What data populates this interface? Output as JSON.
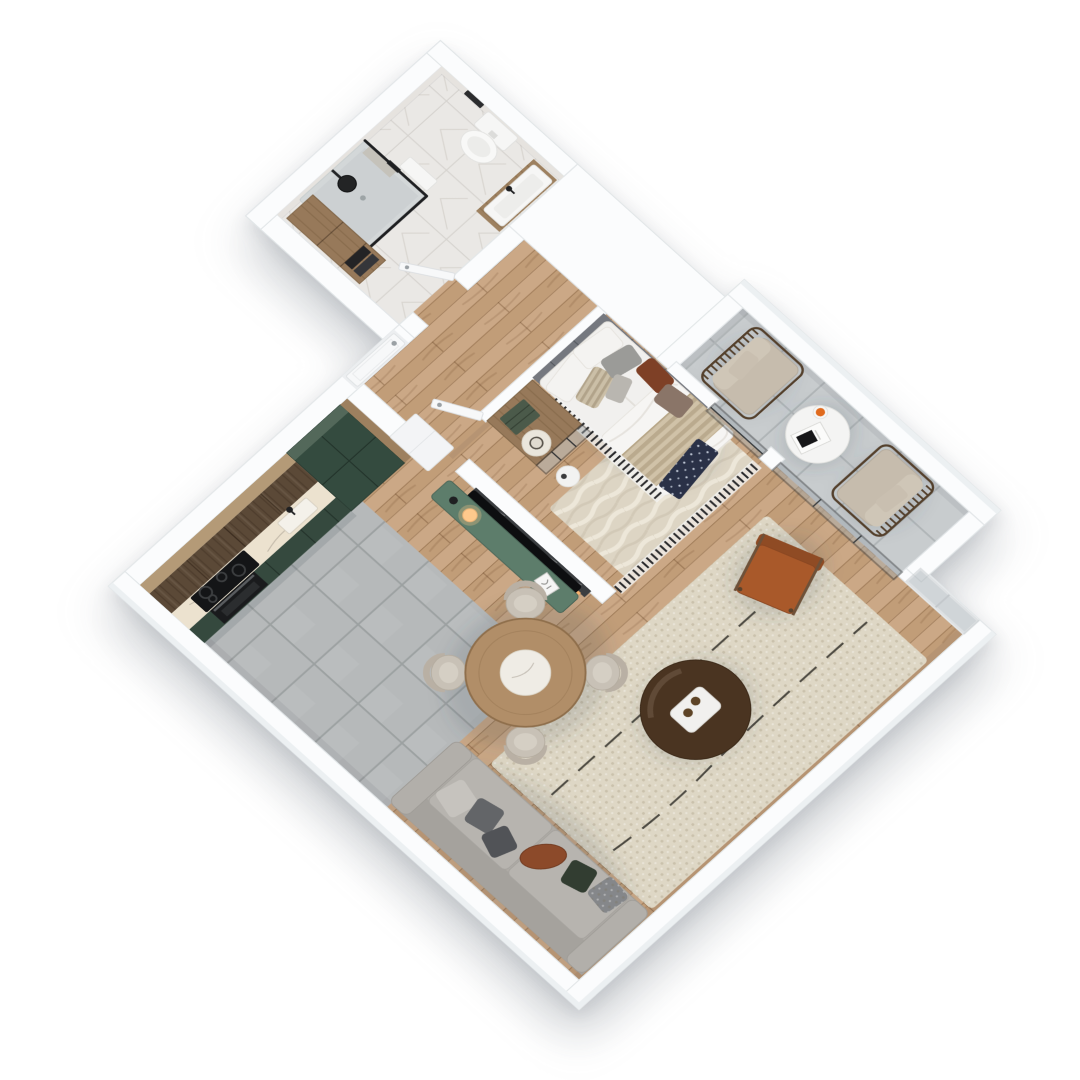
{
  "meta": {
    "description": "Photorealistic 3D axonometric floor plan rendering of a one-bedroom apartment, viewed top-down and rotated 45 degrees on a white background",
    "view": "axonometric top-down, rotated",
    "background": "#ffffff"
  },
  "palette": {
    "background": "#ffffff",
    "wall": "#fbfcfd",
    "floor_wood": "#c8a37e",
    "floor_tile_kitchen": "#b6b9ba",
    "floor_tile_balcony": "#c8ccce",
    "floor_marble": "#eae8e5",
    "cabinet_green_dark": "#344b3f",
    "cabinet_green_top": "#53685a",
    "cabinet_base_green": "#35493e",
    "wood_dark": "#5b4937",
    "wood_light": "#9d805f",
    "wood_cap": "#b49a77",
    "counter_marble": "#ece2cf",
    "appliance_black": "#141517",
    "oven_black": "#1a1b1d",
    "sink_white": "#f4f1ea",
    "console_green": "#5d7d6b",
    "tv_black": "#0d0e10",
    "tv_wall_marble": "#3b3e41",
    "led_warm": "#ffb66b",
    "sofa_base": "#aeaba6",
    "sofa_seat": "#b7b4af",
    "sofa_back": "#a5a29d",
    "pillow_light": "#c6c3be",
    "pillow_mid": "#636568",
    "pillow_dark": "#515357",
    "pillow_green": "#323d31",
    "pillow_leather": "#8c4a2a",
    "pillow_knit": "#85878a",
    "rug_living": "#ded7c5",
    "rug_bedroom": "#ddd5c4",
    "pouf_brown": "#4a3421",
    "tray_white": "#f1f0ee",
    "glass_drink": "#5e4426",
    "chair_leather": "#a9592a",
    "chair_leather_dark": "#8f4b24",
    "chair_wood": "#6e5139",
    "dining_wood": "#b18e68",
    "dining_marble": "#efece5",
    "dining_chair": "#c8c1b6",
    "bed_white": "#f1f0ee",
    "duvet": "#f6f5f3",
    "headboard_grey": "#75787f",
    "throw_beige": "#d0c2a8",
    "pillow_rust": "#7e4026",
    "pillow_taupe": "#8a7568",
    "blanket_navy": "#2a3147",
    "wardrobe_wood": "#97795a",
    "hat_white": "#eae6dc",
    "clothes_green": "#4b5a4a",
    "baluster_dark": "#2c2c2e",
    "glass_tint": "#a7b0b4",
    "frame_silver": "#c3c8cb",
    "door_white": "#f7f8f9",
    "handle_chrome": "#9aa0a4",
    "fixture_white": "#f6f6f5",
    "fixture_black": "#232425",
    "armchair_cushion": "#c6bcad",
    "armchair_frame": "#54402c",
    "side_table_white": "#f4f4f3",
    "cup_orange": "#e06a1d",
    "lamp_glow": "#ffc98c",
    "towel_dark": "#232325"
  },
  "scene": {
    "rooms": [
      {
        "id": "bathroom",
        "label": "Bathroom",
        "items": [
          "marble floor and walls",
          "black framed glass shower",
          "black rain shower head",
          "wall-hung toilet",
          "white basin on wood vanity",
          "tall wood cabinet",
          "dark towels",
          "towel bar",
          "open white door"
        ]
      },
      {
        "id": "hallway",
        "label": "Hallway",
        "items": [
          "white entrance door with chrome handle",
          "white low cabinet",
          "white pier",
          "wood floor"
        ]
      },
      {
        "id": "kitchen",
        "label": "Kitchen",
        "items": [
          "dark wood upper cabinets",
          "marble countertop",
          "black induction cooktop",
          "black built-in oven",
          "undermount sink with black faucet",
          "dark green base cabinets",
          "tall green cabinet columns",
          "grey tile floor"
        ]
      },
      {
        "id": "dining",
        "label": "Dining area",
        "items": [
          "round wood table with marble lazy-susan",
          "four beige upholstered chairs"
        ]
      },
      {
        "id": "living",
        "label": "Living room",
        "items": [
          "grey sofa with cushions",
          "cognac leather cushion",
          "cream shag rug with black dashed lines",
          "dark brown round pouf with white tray and two glasses",
          "cognac leather armchair",
          "green media console with sphere lamp and frame",
          "wall-mounted TV on half wall with dark marble inset and warm LED"
        ]
      },
      {
        "id": "bedroom",
        "label": "Bedroom",
        "items": [
          "double bed with white linens",
          "grey upholstered corner headboard",
          "striped beige throw",
          "rust and taupe accent pillows",
          "navy blanket at foot",
          "slatted railing",
          "open wood wardrobe with hat and folded green clothes",
          "glass wardrobe front",
          "white stool",
          "beige rug",
          "open white door"
        ]
      },
      {
        "id": "balcony",
        "label": "Balcony",
        "items": [
          "two wood spindle armchairs with beige cushions",
          "round white side table",
          "magazine",
          "orange cup",
          "large grey floor tiles",
          "glass sliding doors",
          "silver framed window"
        ]
      }
    ]
  }
}
